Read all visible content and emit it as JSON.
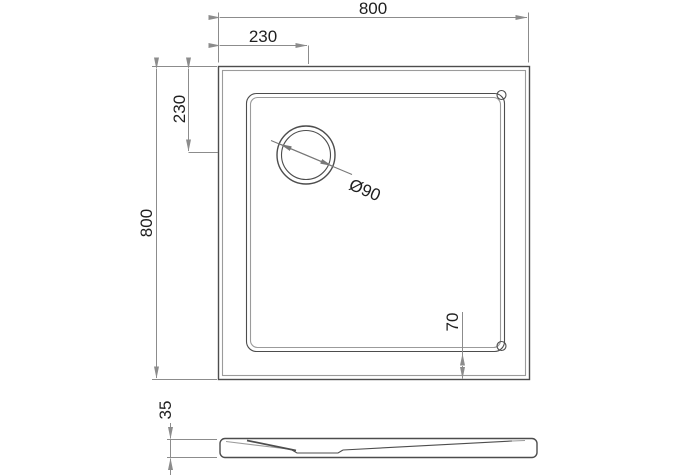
{
  "drawing": {
    "kind": "shower-tray-plan-and-profile",
    "dimensions": {
      "overall_width": "800",
      "overall_height": "800",
      "drain_offset_x": "230",
      "drain_offset_y": "230",
      "drain_diameter": "Ø90",
      "basin_rim_offset": "70",
      "tray_thickness": "35"
    },
    "colors": {
      "background": "#ffffff",
      "outline_dark": "#4d4d4d",
      "outline_light": "#9b9b9b",
      "dimension_line": "#8c8c8c",
      "text": "#1f1f1f"
    }
  }
}
